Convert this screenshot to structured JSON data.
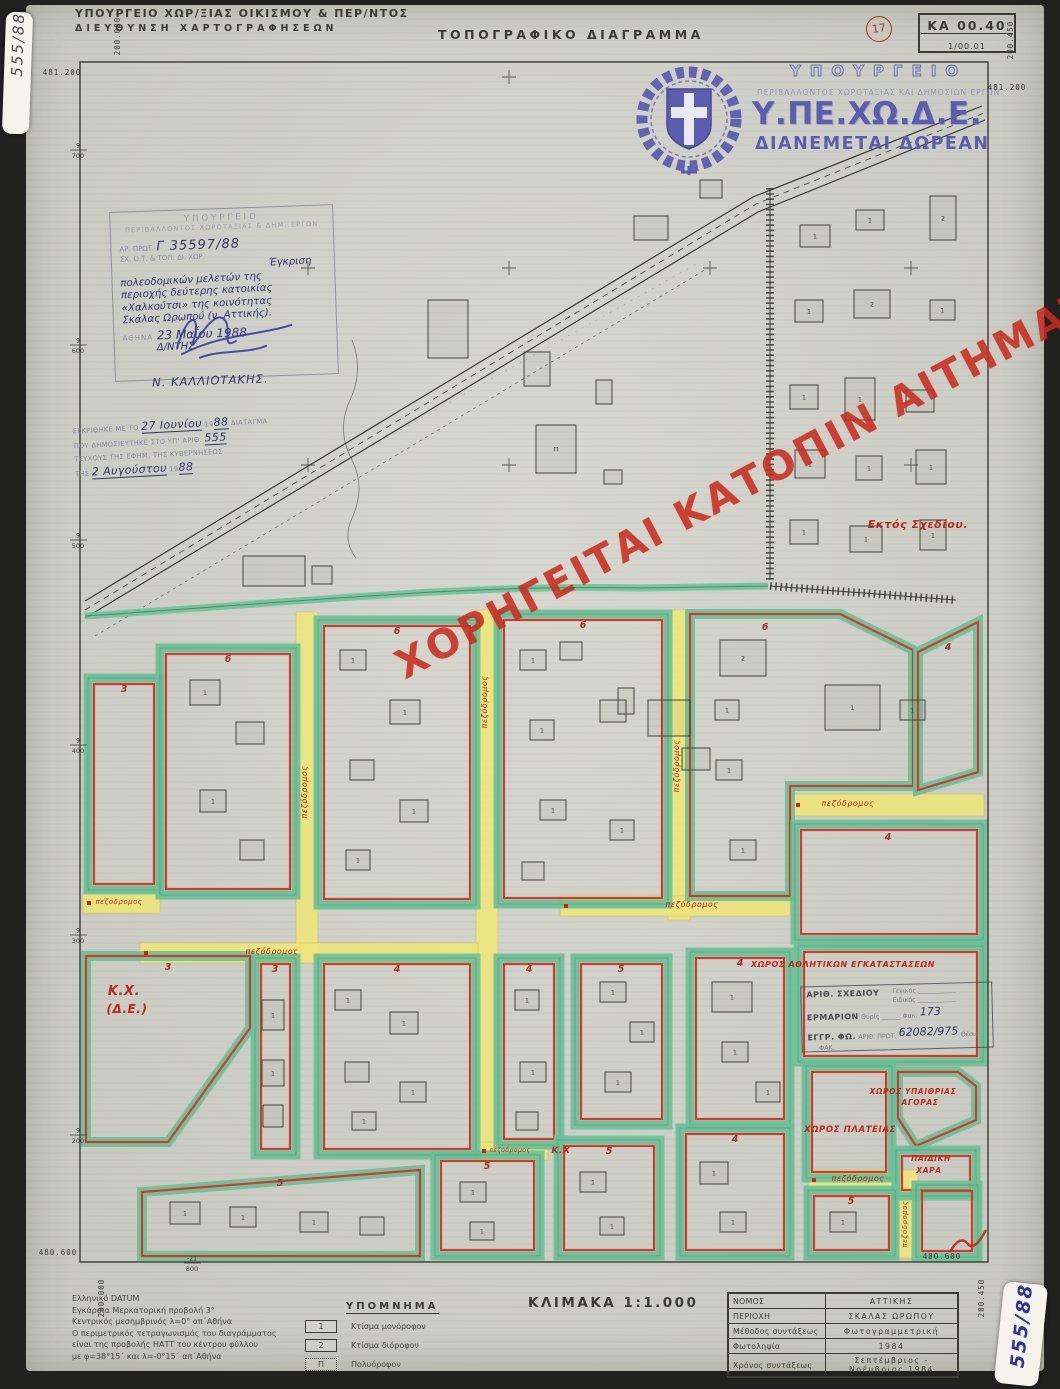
{
  "colors": {
    "paper": "#d2d3ca",
    "ink": "#3b3b33",
    "green": "#6cbf97",
    "green_dark": "#2a8a5f",
    "red": "#d23b2c",
    "yellow": "#eee67c",
    "red_ink": "#c0281a",
    "blue_ink": "#3c3c9e",
    "logo_blue": "#5d5db0",
    "stamp_gray": "#8d8da2",
    "watermark": "#c92a1c"
  },
  "header": {
    "ministry_line1": "ΥΠΟΥΡΓΕΙΟ ΧΩΡ/ΞΙΑΣ ΟΙΚΙΣΜΟΥ & ΠΕΡ/ΝΤΟΣ",
    "ministry_line2": "ΔΙΕΥΘΥΝΣΗ ΧΑΡΤΟΓΡΑΦΗΣΕΩΝ",
    "title": "ΤΟΠΟΓΡΑΦΙΚΟ ΔΙΑΓΡΑΜΜΑ",
    "sheet_circle": "17",
    "sheet_code": "ΚΑ 00.40",
    "sheet_sub": "1/00.01"
  },
  "stickers": {
    "top_left": "555/88",
    "bottom_right": "555/88"
  },
  "logo": {
    "line1": "ΥΠΟΥΡΓΕΙΟ",
    "line2": "ΠΕΡΙΒΑΛΛΟΝΤΟΣ ΧΩΡΟΤΑΞΙΑΣ ΚΑΙ ΔΗΜΟΣΙΩΝ ΕΡΓΩΝ",
    "acronym": "Υ.ΠΕ.ΧΩ.Δ.Ε.",
    "free": "ΔΙΑΝΕΜΕΤΑΙ ΔΩΡΕΑΝ"
  },
  "watermark": "ΧΟΡΗΓΕΙΤΑΙ ΚΑΤΟΠΙΝ ΑΙΤΗΜΑΤΟΣ",
  "approval_stamp": {
    "org1": "ΥΠΟΥΡΓΕΙΟ",
    "org2": "ΠΕΡΙΒΑΛΛΟΝΤΟΣ ΧΩΡΟΤΑΞΙΑΣ & ΔΗΜ. ΕΡΓΩΝ",
    "proto_label": "ΑΡ. ΠΡΩΤ.",
    "proto_value": "Γ 35597/88",
    "sub_label": "ΣΧ. Ο.Τ. & ΤΟΠ. ΔΙ. ΧΩΡ.",
    "subject_lines": [
      "Έγκριση",
      "πολεοδομικών μελετών της",
      "περιοχής δεύτερης κατοικίας",
      "«Χαλκούτσι» της κοινότητας",
      "Σκάλας Ωρωπού (ν. Αττικής)."
    ],
    "place_label": "ΑΘΗΝΑ",
    "date_value": "23 Μαΐου 1988",
    "director_label": "Δ/ΝΤΗΣ",
    "signatory": "Ν. ΚΑΛΛΙΟΤΑΚΗΣ."
  },
  "gazette_stamp": {
    "l1a": "ΕΓΚΡΙΘΗΚΕ ΜΕ ΤΟ",
    "l1hw": "27 Ιουνίου",
    "l1b": "19",
    "l1hw2": "88",
    "l1c": "ΔΙΑΤΑΓΜΑ",
    "l2a": "ΠΟΥ ΔΗΜΟΣΙΕΥΤΗΚΕ ΣΤΟ ΥΠ' ΑΡΙΘ.",
    "l2hw": "555",
    "l3": "ΤΕΥΧΟΥΣ ΤΗΣ ΕΦΗΜ. ΤΗΣ ΚΥΒΕΡΝΗΣΕΩΣ",
    "l4a": "ΤΗΣ",
    "l4hw": "2 Αυγούστου",
    "l4b": "19",
    "l4hw2": "88"
  },
  "archive_stamp": {
    "r1a": "ΑΡΙΘ. ΣΧΕΔΙΟΥ",
    "r1b": "Γενικός",
    "r1c": "Ειδικός",
    "r2a": "ΕΡΜΑΡΙΟΝ",
    "r2b": "Θυρίς",
    "r2c": "Φακ.",
    "r2hw": "173",
    "r3a": "ΕΓΓΡ. ΦΩ.",
    "r3b": "ΑΡΙΘ. ΠΡΩΤ.",
    "r3hw": "62082/975",
    "r3c": "Θέσις",
    "r3d": "ΦΑΚ."
  },
  "legend": {
    "heading": "ΥΠΟΜΝΗΜΑ",
    "items": [
      {
        "sym": "1",
        "label": "Κτίσμα μονόροφον"
      },
      {
        "sym": "2",
        "label": "Κτίσμα διόροφον"
      },
      {
        "sym": "Π",
        "label": "Πολυόροφον"
      }
    ]
  },
  "scale_label": "ΚΛΙΜΑΚΑ 1:1.000",
  "datum_lines": [
    "Ελληνικό DATUM",
    "Εγκάρσια Μερκατορική προβολή 3°",
    "Κεντρικός μεσημβρινός λ=0°  απ΄Αθήνα",
    "Ο περιμετρικός τετραγωνισμός του διαγράμματος",
    "είναι της προβολής ΗΑΤΤ του κέντρου φύλλου",
    "με φ=38°15΄ και λ=-0°15΄  απ΄Αθήνα"
  ],
  "info_table": {
    "rows": [
      [
        "ΝΟΜΟΣ",
        "ΑΤΤΙΚΗΣ"
      ],
      [
        "ΠΕΡΙΟΧΗ",
        "ΣΚΑΛΑΣ ΩΡΩΠΟΥ"
      ],
      [
        "Μέθοδος συντάξεως",
        "Φωτογραμμετρική"
      ],
      [
        "Φωτοληψία",
        "1984"
      ],
      [
        "Χρόνος συντάξεως",
        "Σεπτέμβριος - Νοέμβριος 1984"
      ]
    ]
  },
  "map": {
    "frame": [
      80,
      62,
      908,
      1200
    ],
    "corner_labels": [
      {
        "t": "481.200",
        "x": 46,
        "y": 75,
        "r": 0
      },
      {
        "t": "200.000",
        "x": 104,
        "y": 36,
        "r": -90
      },
      {
        "t": "200.450",
        "x": 997,
        "y": 40,
        "r": -90
      },
      {
        "t": "481.200",
        "x": 991,
        "y": 90,
        "r": 0
      },
      {
        "t": "480.600",
        "x": 42,
        "y": 1255,
        "r": 0
      },
      {
        "t": "200.000",
        "x": 88,
        "y": 1298,
        "r": -90
      },
      {
        "t": "480.600",
        "x": 926,
        "y": 1259,
        "r": 0
      },
      {
        "t": "200.450",
        "x": 968,
        "y": 1298,
        "r": -90
      }
    ],
    "edge_fractions": [
      [
        "9",
        "700",
        150,
        78
      ],
      [
        "9",
        "600",
        345,
        78
      ],
      [
        "9",
        "500",
        540,
        78
      ],
      [
        "9",
        "400",
        745,
        78
      ],
      [
        "9",
        "300",
        935,
        78
      ],
      [
        "9",
        "200",
        1135,
        78
      ],
      [
        "-21",
        "800",
        1263,
        192
      ]
    ],
    "crosses": [
      [
        509,
        77
      ],
      [
        308,
        268
      ],
      [
        509,
        268
      ],
      [
        710,
        268
      ],
      [
        911,
        268
      ],
      [
        308,
        465
      ],
      [
        509,
        465
      ],
      [
        911,
        465
      ]
    ],
    "out_of_plan_label": "Εκτός Σχεδίου.",
    "street_label": "πεζόδρομος",
    "streets": [
      [
        296,
        612,
        22,
        348
      ],
      [
        476,
        610,
        22,
        550
      ],
      [
        668,
        610,
        22,
        310
      ],
      [
        83,
        893,
        77,
        20
      ],
      [
        140,
        943,
        338,
        20
      ],
      [
        560,
        896,
        230,
        20
      ],
      [
        792,
        794,
        192,
        22
      ],
      [
        808,
        1170,
        110,
        20
      ],
      [
        897,
        1188,
        20,
        70
      ],
      [
        478,
        1142,
        70,
        18
      ]
    ],
    "street_labels": [
      [
        307,
        792,
        -90,
        8
      ],
      [
        487,
        702,
        -90,
        8
      ],
      [
        679,
        766,
        -90,
        8
      ],
      [
        119,
        904,
        0,
        7
      ],
      [
        272,
        954,
        0,
        8
      ],
      [
        692,
        907,
        0,
        8
      ],
      [
        848,
        806,
        0,
        8
      ],
      [
        858,
        1181,
        0,
        8
      ],
      [
        907,
        1224,
        -90,
        7
      ],
      [
        510,
        1152,
        0,
        6
      ]
    ],
    "blocks": [
      {
        "r": [
          88,
          678,
          72,
          212
        ],
        "n": "3",
        "nx": 124,
        "ny": 692
      },
      {
        "r": [
          160,
          648,
          136,
          247
        ],
        "n": "6",
        "nx": 228,
        "ny": 662
      },
      {
        "r": [
          318,
          620,
          158,
          285
        ],
        "n": "6",
        "nx": 397,
        "ny": 634
      },
      {
        "r": [
          498,
          614,
          170,
          290
        ],
        "n": "6",
        "nx": 583,
        "ny": 628
      },
      {
        "p": [
          [
            690,
            614
          ],
          [
            840,
            614
          ],
          [
            913,
            650
          ],
          [
            913,
            786
          ],
          [
            790,
            786
          ],
          [
            790,
            896
          ],
          [
            690,
            896
          ]
        ],
        "n": "6",
        "nx": 765,
        "ny": 630
      },
      {
        "p": [
          [
            918,
            652
          ],
          [
            978,
            622
          ],
          [
            978,
            772
          ],
          [
            918,
            790
          ]
        ],
        "n": "4",
        "nx": 948,
        "ny": 650
      },
      {
        "r": [
          795,
          824,
          188,
          116
        ],
        "n": "4",
        "nx": 888,
        "ny": 840
      },
      {
        "r": [
          255,
          958,
          41,
          197
        ],
        "n": "3",
        "nx": 275,
        "ny": 972
      },
      {
        "r": [
          318,
          958,
          158,
          197
        ],
        "n": "4",
        "nx": 397,
        "ny": 972
      },
      {
        "r": [
          498,
          958,
          62,
          187
        ],
        "n": "4",
        "nx": 529,
        "ny": 972
      },
      {
        "r": [
          575,
          958,
          93,
          167
        ],
        "n": "5",
        "nx": 621,
        "ny": 972
      },
      {
        "r": [
          690,
          952,
          100,
          173
        ],
        "n": "4",
        "nx": 740,
        "ny": 966
      },
      {
        "r": [
          798,
          946,
          185,
          116
        ],
        "n": "",
        "nx": 0,
        "ny": 0
      },
      {
        "p": [
          [
            86,
            956
          ],
          [
            250,
            956
          ],
          [
            250,
            1028
          ],
          [
            168,
            1142
          ],
          [
            86,
            1142
          ]
        ],
        "n": "3",
        "nx": 168,
        "ny": 970
      },
      {
        "r": [
          806,
          1066,
          86,
          112
        ],
        "n": "",
        "nx": 0,
        "ny": 0
      },
      {
        "p": [
          [
            898,
            1072
          ],
          [
            958,
            1072
          ],
          [
            976,
            1086
          ],
          [
            976,
            1120
          ],
          [
            916,
            1146
          ],
          [
            898,
            1118
          ]
        ],
        "n": "",
        "nx": 0,
        "ny": 0
      },
      {
        "r": [
          896,
          1150,
          80,
          46
        ],
        "n": "",
        "nx": 0,
        "ny": 0
      },
      {
        "p": [
          [
            142,
            1192
          ],
          [
            420,
            1170
          ],
          [
            420,
            1256
          ],
          [
            142,
            1256
          ]
        ],
        "n": "5",
        "nx": 280,
        "ny": 1186
      },
      {
        "r": [
          435,
          1155,
          105,
          101
        ],
        "n": "5",
        "nx": 487,
        "ny": 1169
      },
      {
        "r": [
          558,
          1140,
          102,
          116
        ],
        "n": "5",
        "nx": 609,
        "ny": 1154
      },
      {
        "r": [
          680,
          1128,
          110,
          128
        ],
        "n": "4",
        "nx": 735,
        "ny": 1142
      },
      {
        "r": [
          808,
          1190,
          87,
          66
        ],
        "n": "5",
        "nx": 851,
        "ny": 1204
      },
      {
        "r": [
          916,
          1185,
          62,
          72
        ],
        "n": "",
        "nx": 0,
        "ny": 0
      }
    ],
    "buildings": [
      [
        243,
        556,
        62,
        30,
        ""
      ],
      [
        312,
        566,
        20,
        18,
        ""
      ],
      [
        428,
        300,
        40,
        58,
        ""
      ],
      [
        524,
        352,
        26,
        34,
        ""
      ],
      [
        596,
        380,
        16,
        24,
        ""
      ],
      [
        634,
        216,
        34,
        24,
        ""
      ],
      [
        536,
        425,
        40,
        48,
        "Π"
      ],
      [
        604,
        470,
        18,
        14,
        ""
      ],
      [
        700,
        180,
        22,
        18,
        ""
      ],
      [
        800,
        225,
        30,
        22,
        "1"
      ],
      [
        856,
        210,
        28,
        20,
        "1"
      ],
      [
        930,
        196,
        26,
        44,
        "2"
      ],
      [
        795,
        300,
        28,
        22,
        "1"
      ],
      [
        854,
        290,
        36,
        28,
        "2"
      ],
      [
        930,
        300,
        25,
        20,
        "1"
      ],
      [
        790,
        385,
        28,
        24,
        "1"
      ],
      [
        845,
        378,
        30,
        42,
        "1"
      ],
      [
        906,
        390,
        28,
        22,
        "1"
      ],
      [
        795,
        450,
        30,
        28,
        "1"
      ],
      [
        856,
        456,
        26,
        24,
        "1"
      ],
      [
        916,
        450,
        30,
        34,
        "1"
      ],
      [
        790,
        520,
        28,
        24,
        "1"
      ],
      [
        850,
        526,
        32,
        26,
        "1"
      ],
      [
        920,
        520,
        26,
        30,
        "1"
      ],
      [
        825,
        685,
        55,
        45,
        "1"
      ],
      [
        900,
        700,
        25,
        20,
        "1"
      ],
      [
        648,
        700,
        42,
        36,
        ""
      ],
      [
        682,
        748,
        28,
        22,
        ""
      ],
      [
        618,
        688,
        16,
        26,
        ""
      ],
      [
        190,
        680,
        30,
        25,
        "1"
      ],
      [
        236,
        722,
        28,
        22,
        ""
      ],
      [
        200,
        790,
        26,
        22,
        "1"
      ],
      [
        240,
        840,
        24,
        20,
        ""
      ],
      [
        340,
        650,
        26,
        20,
        "1"
      ],
      [
        390,
        700,
        30,
        24,
        "1"
      ],
      [
        350,
        760,
        24,
        20,
        ""
      ],
      [
        400,
        800,
        28,
        22,
        "1"
      ],
      [
        346,
        850,
        24,
        20,
        "1"
      ],
      [
        520,
        650,
        26,
        20,
        "1"
      ],
      [
        560,
        642,
        22,
        18,
        ""
      ],
      [
        530,
        720,
        24,
        20,
        "1"
      ],
      [
        600,
        700,
        26,
        22,
        ""
      ],
      [
        540,
        800,
        26,
        20,
        "1"
      ],
      [
        610,
        820,
        24,
        20,
        "1"
      ],
      [
        522,
        862,
        22,
        18,
        ""
      ],
      [
        720,
        640,
        46,
        36,
        "2"
      ],
      [
        715,
        700,
        24,
        20,
        "1"
      ],
      [
        716,
        760,
        26,
        20,
        "1"
      ],
      [
        730,
        840,
        26,
        20,
        "1"
      ],
      [
        262,
        1000,
        22,
        30,
        "1"
      ],
      [
        262,
        1060,
        22,
        26,
        "1"
      ],
      [
        263,
        1105,
        20,
        22,
        ""
      ],
      [
        335,
        990,
        26,
        20,
        "1"
      ],
      [
        390,
        1012,
        28,
        22,
        "1"
      ],
      [
        345,
        1062,
        24,
        20,
        ""
      ],
      [
        400,
        1082,
        26,
        20,
        "1"
      ],
      [
        352,
        1112,
        24,
        18,
        "1"
      ],
      [
        515,
        990,
        24,
        20,
        "1"
      ],
      [
        520,
        1062,
        26,
        20,
        "1"
      ],
      [
        516,
        1112,
        22,
        18,
        ""
      ],
      [
        600,
        982,
        26,
        20,
        "1"
      ],
      [
        630,
        1022,
        24,
        20,
        "1"
      ],
      [
        605,
        1072,
        26,
        20,
        "1"
      ],
      [
        712,
        982,
        40,
        30,
        "1"
      ],
      [
        722,
        1042,
        26,
        20,
        "1"
      ],
      [
        756,
        1082,
        24,
        20,
        "1"
      ],
      [
        170,
        1202,
        30,
        22,
        "1"
      ],
      [
        230,
        1207,
        26,
        20,
        "1"
      ],
      [
        300,
        1212,
        28,
        20,
        "1"
      ],
      [
        360,
        1217,
        24,
        18,
        ""
      ],
      [
        460,
        1182,
        26,
        20,
        "1"
      ],
      [
        470,
        1222,
        24,
        18,
        "1"
      ],
      [
        580,
        1172,
        26,
        20,
        "1"
      ],
      [
        600,
        1217,
        24,
        18,
        "1"
      ],
      [
        700,
        1162,
        28,
        22,
        "1"
      ],
      [
        720,
        1212,
        26,
        20,
        "1"
      ],
      [
        830,
        1212,
        26,
        20,
        "1"
      ]
    ],
    "red_labels": [
      [
        843,
        967,
        "ΧΩΡΟΣ ΑΘΛΗΤΙΚΩΝ ΕΓΚΑΤΑΣΤΑΣΕΩΝ",
        8
      ],
      [
        913,
        1094,
        "ΧΩΡΟΣ ΥΠΑΙΘΡΙΑΣ",
        7.5
      ],
      [
        920,
        1105,
        "ΑΓΟΡΑΣ",
        7.5
      ],
      [
        850,
        1132,
        "ΧΩΡΟΣ ΠΛΑΤΕΙΑΣ",
        8.5
      ],
      [
        931,
        1161,
        "ΠΑΙΔΙΚΗ",
        7.5
      ],
      [
        929,
        1173,
        "ΧΑΡΑ",
        7.5
      ],
      [
        124,
        995,
        "Κ.Χ.",
        13
      ],
      [
        127,
        1013,
        "(Δ.Ε.)",
        12
      ],
      [
        561,
        1153,
        "Κ.Χ",
        9
      ],
      [
        918,
        528,
        "Εκτός Σχεδίου.",
        11
      ]
    ]
  }
}
